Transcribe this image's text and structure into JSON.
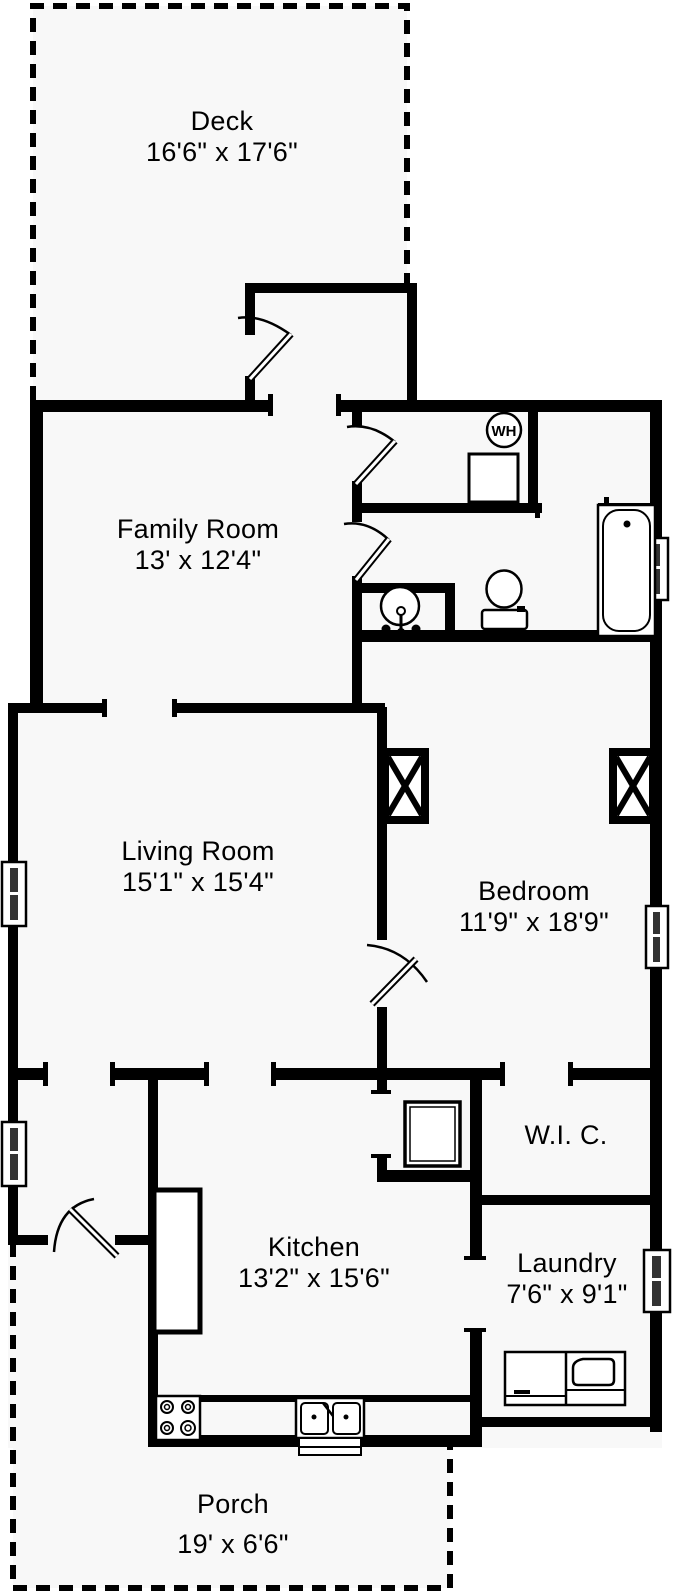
{
  "title": "Single-story house floor plan",
  "rooms": {
    "deck": {
      "name": "Deck",
      "dims": "16'6\" x 17'6\""
    },
    "family_room": {
      "name": "Family Room",
      "dims": "13' x 12'4\""
    },
    "living_room": {
      "name": "Living Room",
      "dims": "15'1\" x 15'4\""
    },
    "bedroom": {
      "name": "Bedroom",
      "dims": "11'9\" x 18'9\""
    },
    "wic": {
      "name": "W.I. C."
    },
    "kitchen": {
      "name": "Kitchen",
      "dims": "13'2\" x 15'6\""
    },
    "laundry": {
      "name": "Laundry",
      "dims": "7'6\" x 9'1\""
    },
    "porch": {
      "name": "Porch",
      "dims": "19' x 6'6\""
    }
  },
  "fixtures": {
    "water_heater_label": "WH",
    "items": [
      "water-heater",
      "bathtub",
      "toilet",
      "pedestal-sink",
      "shower",
      "pantry-cabinet",
      "stove",
      "kitchen-sink",
      "washer-dryer"
    ]
  },
  "colors": {
    "wall": "#000000",
    "floor": "#f8f8f8",
    "background": "#ffffff"
  }
}
